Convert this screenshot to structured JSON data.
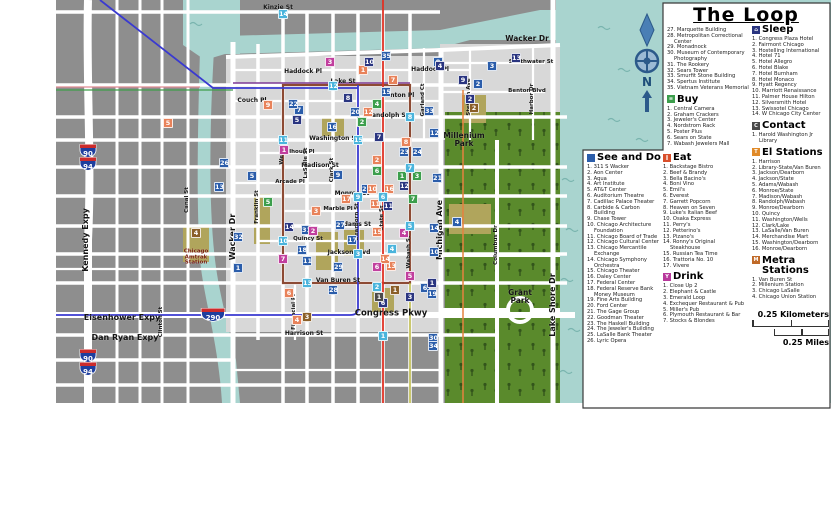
{
  "legend": {
    "title": "The Loop",
    "see_do": {
      "label": "See and Do",
      "icon_glyph": "",
      "icon_color": "#2b5daa",
      "items": [
        "311 S Wacker",
        "Aon Center",
        "Aqua",
        "Art Institute",
        "AT&T Center",
        "Auditorium Theatre",
        "Cadillac Palace Theater",
        "Carbide & Carbon Building",
        "Chase Tower",
        "Chicago Architecture Foundation",
        "Chicago Board of Trade",
        "Chicago Cultural Center",
        "Chicago Mercantile Exchange",
        "Chicago Symphony Orchestra",
        "Chicago Theater",
        "Daley Center",
        "Federal Center",
        "Federal Reserve Bank Money Museum",
        "Fine Arts Building",
        "Ford Center",
        "The Gage Group",
        "Goodman Theater",
        "The Haskell Building",
        "The Jeweler's Building",
        "LaSalle Bank Theater",
        "Lyric Opera"
      ],
      "items_cont": [
        "Marquette Building",
        "Metropolitan Correctional Center",
        "Monadnock",
        "Museum of Contemporary Photography",
        "The Rookery",
        "Sears Tower",
        "Smurfit Stone Building",
        "Spertus Institute",
        "Vietnam Veterans Memorial"
      ]
    },
    "buy": {
      "label": "Buy",
      "icon_glyph": "≡",
      "icon_color": "#3c9e4c",
      "items": [
        "Central Camera",
        "Graham Crackers",
        "Jeweler's Center",
        "Nordstrom Rack",
        "Poster Plus",
        "Sears on State",
        "Wabash Jewelers Mall"
      ]
    },
    "eat": {
      "label": "Eat",
      "icon_glyph": "∥",
      "icon_color": "#d94f2b",
      "items": [
        "Backstage Bistro",
        "Beef & Brandy",
        "Bella Bacino's",
        "Boni Vino",
        "Emil's",
        "Everest",
        "Garrett Popcorn",
        "Heaven on Seven",
        "Luke's Italian Beef",
        "Osaka Express",
        "Perry's",
        "Petterino's",
        "Pizano's",
        "Ronny's Original Steakhouse",
        "Russian Tea Time",
        "Trattoria No. 10",
        "Vivere"
      ]
    },
    "drink": {
      "label": "Drink",
      "icon_glyph": "Y",
      "icon_color": "#b8399c",
      "items": [
        "Close Up 2",
        "Elephant & Castle",
        "Emerald Loop",
        "Exchequer Restaurant & Pub",
        "Miller's Pub",
        "Plymouth Restaurant & Bar",
        "Stocks & Blondes"
      ]
    },
    "sleep": {
      "label": "Sleep",
      "icon_glyph": "⌂",
      "icon_color": "#2a3580",
      "items": [
        "Congress Plaza Hotel",
        "Fairmont Chicago",
        "Hostelling International",
        "Hotel 71",
        "Hotel Allegro",
        "Hotel Blake",
        "Hotel Burnham",
        "Hotel Monaco",
        "Hyatt Regency",
        "Marriott Renaissance",
        "Palmer House Hilton",
        "Silversmith Hotel",
        "Swissotel Chicago",
        "W Chicago City Center"
      ]
    },
    "contact": {
      "label": "Contact",
      "icon_glyph": "C",
      "icon_color": "#4a4a4a",
      "items": [
        "Harold Washington Jr Library"
      ]
    },
    "el": {
      "label": "El Stations",
      "icon_glyph": "T",
      "icon_color": "#e08a28",
      "items": [
        "Harrison",
        "Library-State/Van Buren",
        "Jackson/Dearborn",
        "Jackson/State",
        "Adams/Wabash",
        "Monroe/State",
        "Madison/Wabash",
        "Randolph/Wabash",
        "Monroe/Dearborn",
        "Quincy",
        "Washington/Wells",
        "Clark/Lake",
        "LaSalle/Van Buren",
        "Merchandise Mart",
        "Washington/Dearborn",
        "Monroe/Dearborn"
      ]
    },
    "metra": {
      "label": "Metra Stations",
      "icon_glyph": "M",
      "icon_color": "#c06a28",
      "items": [
        "Van Buren St",
        "Millenium Station",
        "Chicago LaSalle",
        "Chicago Union Station"
      ]
    },
    "scale": {
      "km": "0.25 Kilometers",
      "mi": "0.25 Miles"
    }
  },
  "map": {
    "compass_n": "N",
    "shields": [
      "90",
      "94",
      "90",
      "94",
      "290"
    ],
    "colors": {
      "see_do": "#2b5daa",
      "eat": "#e8825a",
      "drink": "#c13f9e",
      "buy": "#3c9e4c",
      "sleep": "#2a3580",
      "el": "#4ab4dc",
      "metra": "#8b5f28",
      "contact": "#4a4a4a"
    },
    "labels": [
      {
        "t": "Kinzie St",
        "x": 278,
        "y": 8
      },
      {
        "t": "Wacker Dr",
        "x": 527,
        "y": 39,
        "s": 7.5
      },
      {
        "t": "Haddock Pl",
        "x": 303,
        "y": 72
      },
      {
        "t": "Haddock Pl",
        "x": 430,
        "y": 70
      },
      {
        "t": "Lake St",
        "x": 343,
        "y": 82
      },
      {
        "t": "Couch Pl",
        "x": 252,
        "y": 101
      },
      {
        "t": "Benton Pl",
        "x": 398,
        "y": 96
      },
      {
        "t": "Southwater St",
        "x": 531,
        "y": 63,
        "s": 5.5
      },
      {
        "t": "Benton Blvd",
        "x": 527,
        "y": 92,
        "s": 5.5
      },
      {
        "t": "Stetson Ave",
        "x": 470,
        "y": 97,
        "r": -90,
        "s": 5.5
      },
      {
        "t": "Harbor Dr",
        "x": 533,
        "y": 99,
        "r": -90,
        "s": 5.5
      },
      {
        "t": "Garland Ct",
        "x": 424,
        "y": 100,
        "r": -90,
        "s": 5.5
      },
      {
        "t": "Randolph St",
        "x": 388,
        "y": 116
      },
      {
        "t": "Washington St",
        "x": 334,
        "y": 139
      },
      {
        "t": "Calhoun Pl",
        "x": 298,
        "y": 153,
        "s": 5.5
      },
      {
        "t": "Madison St",
        "x": 320,
        "y": 166
      },
      {
        "t": "Arcade Pl",
        "x": 290,
        "y": 183,
        "s": 5.5
      },
      {
        "t": "Monroe St",
        "x": 352,
        "y": 194
      },
      {
        "t": "Marble Pl",
        "x": 338,
        "y": 210,
        "s": 5.5
      },
      {
        "t": "Adams St",
        "x": 355,
        "y": 225
      },
      {
        "t": "Quincy St",
        "x": 308,
        "y": 240,
        "s": 5.5
      },
      {
        "t": "Jackson Blvd",
        "x": 349,
        "y": 253
      },
      {
        "t": "Van Buren St",
        "x": 338,
        "y": 281
      },
      {
        "t": "Congress Pkwy",
        "x": 391,
        "y": 314,
        "s": 8.5
      },
      {
        "t": "Harrison St",
        "x": 304,
        "y": 334
      },
      {
        "t": "Eisenhower Expy",
        "x": 122,
        "y": 318,
        "s": 8
      },
      {
        "t": "Dan Ryan Expy",
        "x": 125,
        "y": 338,
        "s": 8
      },
      {
        "t": "Kennedy Expy",
        "x": 86,
        "y": 240,
        "r": -90,
        "s": 8
      },
      {
        "t": "Wacker Dr",
        "x": 233,
        "y": 237,
        "r": -90,
        "s": 8
      },
      {
        "t": "Michigan Ave",
        "x": 440,
        "y": 230,
        "r": -90,
        "s": 8
      },
      {
        "t": "Lake Shore Dr",
        "x": 553,
        "y": 305,
        "r": -90,
        "s": 8
      },
      {
        "t": "Columbus Dr",
        "x": 497,
        "y": 245,
        "r": -90,
        "s": 5.5
      },
      {
        "t": "Canal St",
        "x": 188,
        "y": 200,
        "r": -90,
        "s": 5.5
      },
      {
        "t": "Clinton St",
        "x": 162,
        "y": 322,
        "r": -90,
        "s": 5.5
      },
      {
        "t": "Franklin St",
        "x": 258,
        "y": 207,
        "r": -90,
        "s": 5.5
      },
      {
        "t": "Wells St",
        "x": 283,
        "y": 152,
        "r": -90,
        "s": 5.5
      },
      {
        "t": "LaSalle St",
        "x": 307,
        "y": 163,
        "r": -90,
        "s": 5.5
      },
      {
        "t": "Clark St",
        "x": 333,
        "y": 170,
        "r": -90,
        "s": 5.5
      },
      {
        "t": "Dearborn St",
        "x": 358,
        "y": 222,
        "r": -90,
        "s": 5.5
      },
      {
        "t": "State St",
        "x": 383,
        "y": 218,
        "r": -90,
        "s": 5.5
      },
      {
        "t": "Wabash St",
        "x": 410,
        "y": 252,
        "r": -90,
        "s": 5.5
      },
      {
        "t": "Financial Pl",
        "x": 295,
        "y": 312,
        "r": -90,
        "s": 5.5
      },
      {
        "t": "Millenium\nPark",
        "x": 464,
        "y": 140,
        "s": 7.5
      },
      {
        "t": "Grant\nPark",
        "x": 520,
        "y": 297,
        "s": 7.5
      },
      {
        "t": "Chicago\nAmtrak\nStation",
        "x": 196,
        "y": 258,
        "s": 5.5,
        "c": "#7a2013"
      }
    ],
    "markers": [
      {
        "c": "see_do",
        "n": 1,
        "x": 238,
        "y": 268
      },
      {
        "c": "see_do",
        "n": 2,
        "x": 478,
        "y": 84
      },
      {
        "c": "see_do",
        "n": 3,
        "x": 492,
        "y": 66
      },
      {
        "c": "see_do",
        "n": 4,
        "x": 457,
        "y": 222
      },
      {
        "c": "see_do",
        "n": 5,
        "x": 252,
        "y": 176
      },
      {
        "c": "see_do",
        "n": 6,
        "x": 425,
        "y": 288
      },
      {
        "c": "see_do",
        "n": 7,
        "x": 299,
        "y": 110
      },
      {
        "c": "see_do",
        "n": 8,
        "x": 438,
        "y": 62
      },
      {
        "c": "see_do",
        "n": 9,
        "x": 338,
        "y": 175
      },
      {
        "c": "see_do",
        "n": 10,
        "x": 434,
        "y": 252
      },
      {
        "c": "see_do",
        "n": 11,
        "x": 307,
        "y": 261
      },
      {
        "c": "see_do",
        "n": 12,
        "x": 434,
        "y": 133
      },
      {
        "c": "see_do",
        "n": 13,
        "x": 219,
        "y": 187
      },
      {
        "c": "see_do",
        "n": 14,
        "x": 434,
        "y": 228
      },
      {
        "c": "see_do",
        "n": 15,
        "x": 386,
        "y": 92
      },
      {
        "c": "see_do",
        "n": 16,
        "x": 332,
        "y": 127
      },
      {
        "c": "see_do",
        "n": 17,
        "x": 352,
        "y": 240
      },
      {
        "c": "see_do",
        "n": 18,
        "x": 302,
        "y": 250
      },
      {
        "c": "see_do",
        "n": 19,
        "x": 432,
        "y": 294
      },
      {
        "c": "see_do",
        "n": 20,
        "x": 355,
        "y": 112
      },
      {
        "c": "see_do",
        "n": 21,
        "x": 437,
        "y": 178
      },
      {
        "c": "see_do",
        "n": 22,
        "x": 293,
        "y": 104
      },
      {
        "c": "see_do",
        "n": 23,
        "x": 404,
        "y": 152
      },
      {
        "c": "see_do",
        "n": 24,
        "x": 417,
        "y": 152
      },
      {
        "c": "see_do",
        "n": 25,
        "x": 366,
        "y": 189
      },
      {
        "c": "see_do",
        "n": 26,
        "x": 224,
        "y": 163
      },
      {
        "c": "see_do",
        "n": 27,
        "x": 340,
        "y": 225
      },
      {
        "c": "see_do",
        "n": 28,
        "x": 333,
        "y": 290
      },
      {
        "c": "see_do",
        "n": 29,
        "x": 338,
        "y": 267
      },
      {
        "c": "see_do",
        "n": 30,
        "x": 433,
        "y": 338
      },
      {
        "c": "see_do",
        "n": 31,
        "x": 306,
        "y": 230
      },
      {
        "c": "see_do",
        "n": 32,
        "x": 238,
        "y": 237
      },
      {
        "c": "see_do",
        "n": 33,
        "x": 429,
        "y": 111
      },
      {
        "c": "see_do",
        "n": 34,
        "x": 433,
        "y": 346
      },
      {
        "c": "see_do",
        "n": 35,
        "x": 386,
        "y": 56
      },
      {
        "c": "eat",
        "n": 1,
        "x": 363,
        "y": 70
      },
      {
        "c": "eat",
        "n": 2,
        "x": 377,
        "y": 160
      },
      {
        "c": "eat",
        "n": 3,
        "x": 316,
        "y": 211
      },
      {
        "c": "eat",
        "n": 4,
        "x": 297,
        "y": 320
      },
      {
        "c": "eat",
        "n": 5,
        "x": 168,
        "y": 123
      },
      {
        "c": "eat",
        "n": 6,
        "x": 289,
        "y": 293
      },
      {
        "c": "eat",
        "n": 7,
        "x": 393,
        "y": 80
      },
      {
        "c": "eat",
        "n": 8,
        "x": 406,
        "y": 142
      },
      {
        "c": "eat",
        "n": 9,
        "x": 268,
        "y": 105
      },
      {
        "c": "eat",
        "n": 10,
        "x": 372,
        "y": 189
      },
      {
        "c": "eat",
        "n": 11,
        "x": 375,
        "y": 204
      },
      {
        "c": "eat",
        "n": 12,
        "x": 368,
        "y": 112
      },
      {
        "c": "eat",
        "n": 13,
        "x": 391,
        "y": 266
      },
      {
        "c": "eat",
        "n": 14,
        "x": 385,
        "y": 259
      },
      {
        "c": "eat",
        "n": 15,
        "x": 377,
        "y": 232
      },
      {
        "c": "eat",
        "n": 16,
        "x": 389,
        "y": 189
      },
      {
        "c": "eat",
        "n": 17,
        "x": 346,
        "y": 199
      },
      {
        "c": "drink",
        "n": 1,
        "x": 284,
        "y": 150
      },
      {
        "c": "drink",
        "n": 2,
        "x": 313,
        "y": 231
      },
      {
        "c": "drink",
        "n": 3,
        "x": 330,
        "y": 62
      },
      {
        "c": "drink",
        "n": 4,
        "x": 404,
        "y": 233
      },
      {
        "c": "drink",
        "n": 5,
        "x": 410,
        "y": 276
      },
      {
        "c": "drink",
        "n": 6,
        "x": 377,
        "y": 267
      },
      {
        "c": "drink",
        "n": 7,
        "x": 283,
        "y": 259
      },
      {
        "c": "buy",
        "n": 1,
        "x": 402,
        "y": 176
      },
      {
        "c": "buy",
        "n": 2,
        "x": 362,
        "y": 122
      },
      {
        "c": "buy",
        "n": 3,
        "x": 417,
        "y": 176
      },
      {
        "c": "buy",
        "n": 4,
        "x": 377,
        "y": 104
      },
      {
        "c": "buy",
        "n": 5,
        "x": 268,
        "y": 202
      },
      {
        "c": "buy",
        "n": 6,
        "x": 377,
        "y": 171
      },
      {
        "c": "buy",
        "n": 7,
        "x": 413,
        "y": 199
      },
      {
        "c": "sleep",
        "n": 1,
        "x": 432,
        "y": 283
      },
      {
        "c": "sleep",
        "n": 2,
        "x": 470,
        "y": 99
      },
      {
        "c": "sleep",
        "n": 3,
        "x": 410,
        "y": 297
      },
      {
        "c": "sleep",
        "n": 4,
        "x": 440,
        "y": 66
      },
      {
        "c": "sleep",
        "n": 5,
        "x": 297,
        "y": 120
      },
      {
        "c": "sleep",
        "n": 6,
        "x": 383,
        "y": 303
      },
      {
        "c": "sleep",
        "n": 7,
        "x": 379,
        "y": 137
      },
      {
        "c": "sleep",
        "n": 8,
        "x": 348,
        "y": 98
      },
      {
        "c": "sleep",
        "n": 9,
        "x": 463,
        "y": 80
      },
      {
        "c": "sleep",
        "n": 10,
        "x": 369,
        "y": 62
      },
      {
        "c": "sleep",
        "n": 11,
        "x": 388,
        "y": 206
      },
      {
        "c": "sleep",
        "n": 12,
        "x": 404,
        "y": 186
      },
      {
        "c": "sleep",
        "n": 13,
        "x": 516,
        "y": 58
      },
      {
        "c": "sleep",
        "n": 14,
        "x": 289,
        "y": 227
      },
      {
        "c": "el",
        "n": 1,
        "x": 383,
        "y": 336
      },
      {
        "c": "el",
        "n": 2,
        "x": 377,
        "y": 287
      },
      {
        "c": "el",
        "n": 3,
        "x": 358,
        "y": 254
      },
      {
        "c": "el",
        "n": 4,
        "x": 392,
        "y": 249
      },
      {
        "c": "el",
        "n": 5,
        "x": 410,
        "y": 226
      },
      {
        "c": "el",
        "n": 6,
        "x": 383,
        "y": 197
      },
      {
        "c": "el",
        "n": 7,
        "x": 410,
        "y": 168
      },
      {
        "c": "el",
        "n": 8,
        "x": 410,
        "y": 117
      },
      {
        "c": "el",
        "n": 9,
        "x": 358,
        "y": 197
      },
      {
        "c": "el",
        "n": 10,
        "x": 283,
        "y": 241
      },
      {
        "c": "el",
        "n": 11,
        "x": 283,
        "y": 140
      },
      {
        "c": "el",
        "n": 12,
        "x": 333,
        "y": 86
      },
      {
        "c": "el",
        "n": 13,
        "x": 307,
        "y": 283
      },
      {
        "c": "el",
        "n": 14,
        "x": 283,
        "y": 14
      },
      {
        "c": "el",
        "n": 15,
        "x": 358,
        "y": 140
      },
      {
        "c": "metra",
        "n": 1,
        "x": 395,
        "y": 290
      },
      {
        "c": "metra",
        "n": 2,
        "x": 474,
        "y": 108
      },
      {
        "c": "metra",
        "n": 3,
        "x": 307,
        "y": 317
      },
      {
        "c": "metra",
        "n": 4,
        "x": 196,
        "y": 233
      },
      {
        "c": "contact",
        "n": 1,
        "x": 379,
        "y": 297
      }
    ]
  }
}
